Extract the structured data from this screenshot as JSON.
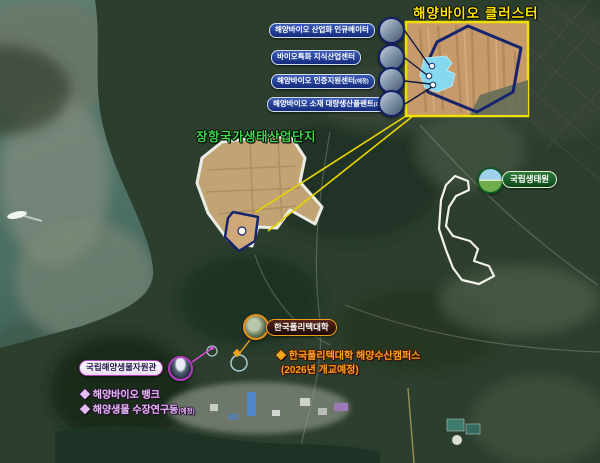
{
  "title": {
    "text": "해양바이오 클러스터"
  },
  "facilities": {
    "items": [
      {
        "label": "해양바이오 산업화 인큐베이터",
        "suffix": ""
      },
      {
        "label": "바이오특화 지식산업센터",
        "suffix": ""
      },
      {
        "label": "해양바이오 인증지원센터",
        "suffix": "(예정)"
      },
      {
        "label": "해양바이오 소재 대량생산플랜트",
        "suffix": "(GMP)"
      }
    ]
  },
  "janghang": {
    "label": "장항국가생태산업단지"
  },
  "ecology": {
    "label": "국립생태원"
  },
  "polytech": {
    "label": "한국폴리텍대학"
  },
  "campus": {
    "line1": "◆ 한국폴리텍대학 해양수산캠퍼스",
    "line2": "(2026년 개교예정)"
  },
  "mabik": {
    "label": "국립해양생물자원관",
    "bullet1": "◆ 해양바이오 뱅크",
    "bullet2": "◆ 해양생물 수장연구동",
    "bullet2_suffix": "(예정)"
  },
  "colors": {
    "accent_yellow": "#ffe400",
    "facility_pill_navy": "#132a7c",
    "janghang_green": "#3ed44c",
    "ecology_green": "#0b4718",
    "mabik_magenta": "#b83cc0",
    "bullet_lavender": "#e5bdf2",
    "campus_orange": "#f6a61d",
    "inset_border_yellow": "#f0e000",
    "inset_site_cyan": "#85d8ee",
    "boundary_navy": "#16246e"
  }
}
